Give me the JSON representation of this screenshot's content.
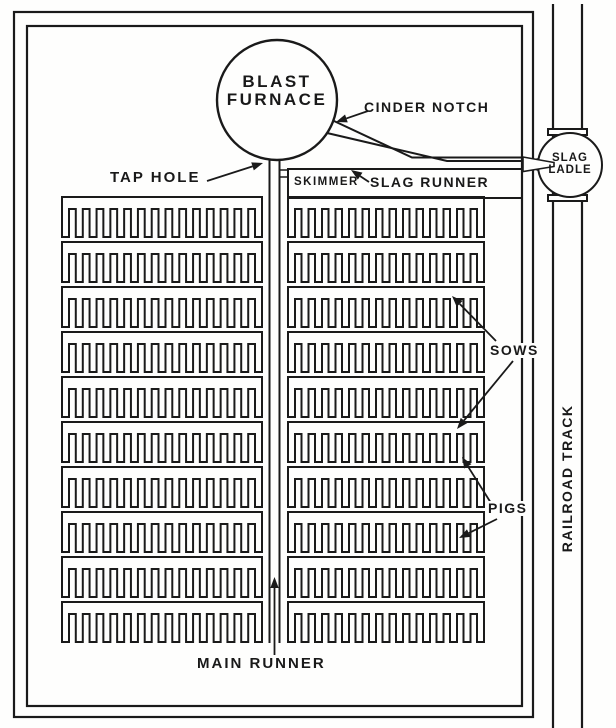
{
  "diagram": {
    "title_semantic": "Blast furnace cast-house pig bed plan",
    "ink_color": "#1a1a1a",
    "paper_color": "#fefefd",
    "furnace": {
      "line1": "BLAST",
      "line2": "FURNACE"
    },
    "slag_ladle": {
      "line1": "SLAG",
      "line2": "LADLE"
    },
    "labels": {
      "cinder_notch": "CINDER NOTCH",
      "tap_hole": "TAP HOLE",
      "skimmer": "SKIMMER",
      "slag_runner": "SLAG RUNNER",
      "sows": "SOWS",
      "pigs": "PIGS",
      "main_runner": "MAIN RUNNER",
      "railroad_track": "RAILROAD TRACK"
    },
    "pig_bed": {
      "rows": 10,
      "row_pitch": 45,
      "first_row_top": 197,
      "spine_height": 12,
      "row_height": 40,
      "tooth_width": 7,
      "columns": [
        {
          "name": "left",
          "x": 62,
          "width": 200,
          "teeth": 15
        },
        {
          "name": "right",
          "x": 288,
          "width": 196,
          "teeth": 15
        }
      ]
    },
    "annotation_arrows": [
      {
        "name": "cinder-notch-arrow",
        "from": [
          368,
          111
        ],
        "to": [
          336,
          122
        ]
      },
      {
        "name": "tap-hole-arrow",
        "from": [
          207,
          181
        ],
        "to": [
          263,
          163
        ]
      },
      {
        "name": "slag-runner-arrow",
        "from": [
          369,
          182
        ],
        "to": [
          351,
          170
        ]
      },
      {
        "name": "sows-arrow-upper",
        "from": [
          496,
          341
        ],
        "to": [
          452,
          296
        ]
      },
      {
        "name": "sows-arrow-lower",
        "from": [
          513,
          361
        ],
        "to": [
          457,
          429
        ]
      },
      {
        "name": "pigs-arrow-upper",
        "from": [
          491,
          503
        ],
        "to": [
          462,
          457
        ]
      },
      {
        "name": "pigs-arrow-lower",
        "from": [
          497,
          519
        ],
        "to": [
          459,
          538
        ]
      },
      {
        "name": "main-runner-arrow",
        "from": [
          274.5,
          655
        ],
        "to": [
          274.5,
          577
        ]
      }
    ]
  }
}
